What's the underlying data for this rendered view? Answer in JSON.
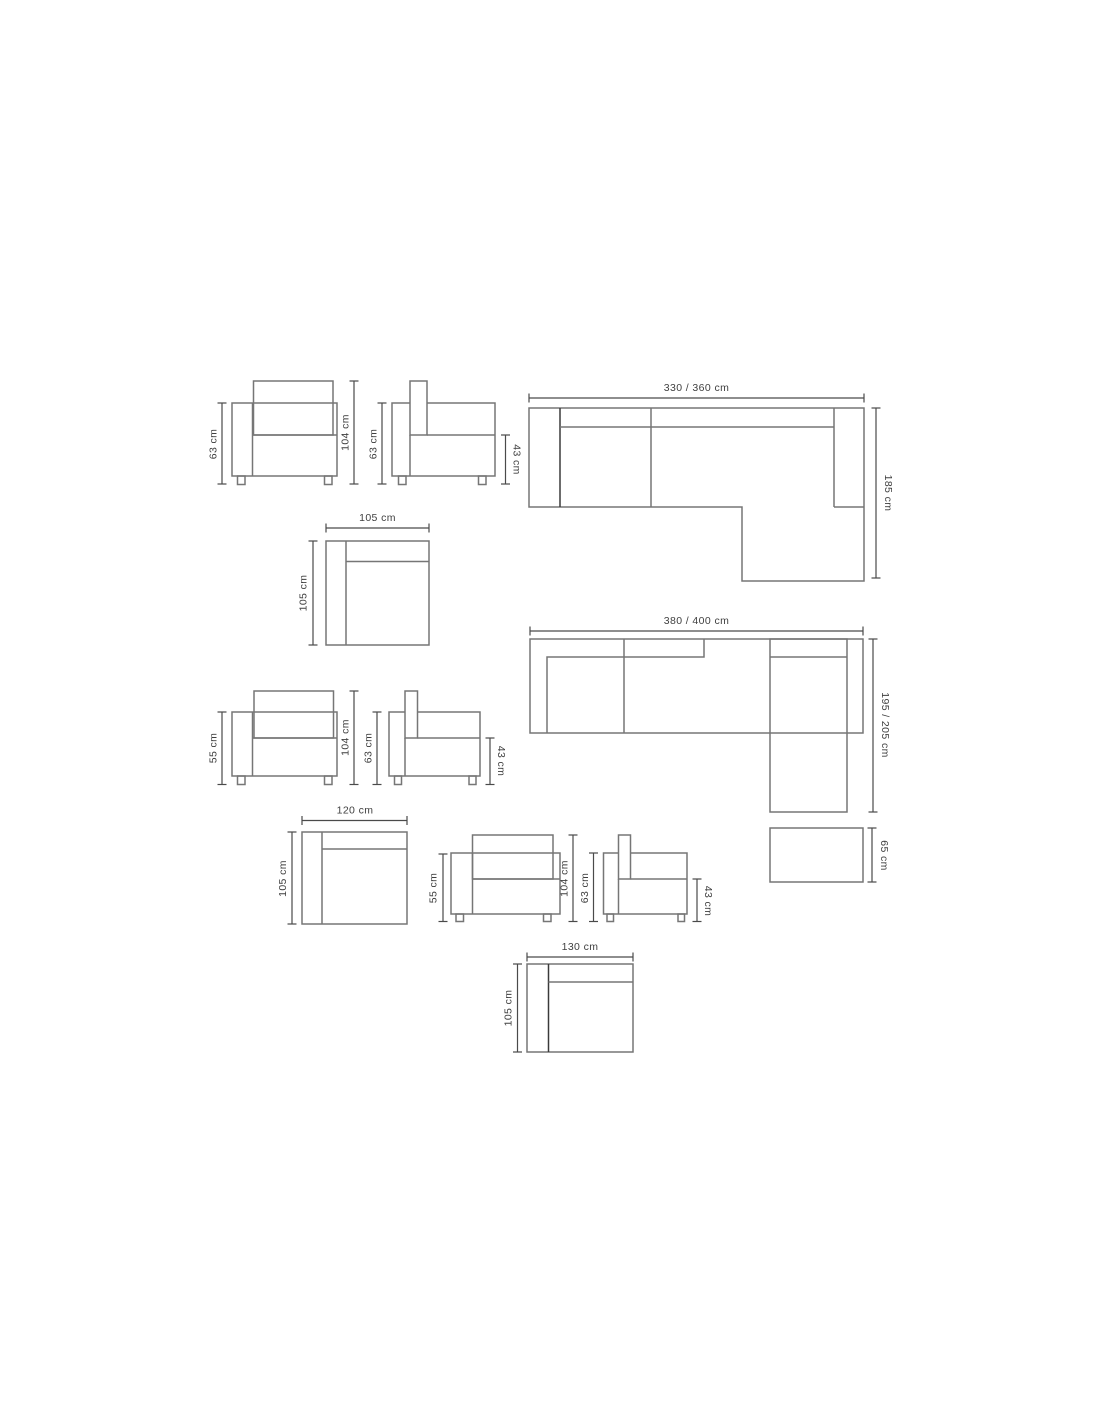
{
  "colors": {
    "background": "#ffffff",
    "furniture_line": "#767676",
    "dimension_line": "#4a4a4a",
    "text": "#3f3f3f"
  },
  "labels": {
    "armchair1_front": {
      "height": "63 cm",
      "total_height": "104 cm"
    },
    "armchair1_side": {
      "height": "63 cm",
      "seat_height": "43 cm"
    },
    "sectional1": {
      "width": "330 / 360 cm",
      "depth": "185 cm"
    },
    "module105": {
      "width": "105 cm",
      "depth": "105 cm"
    },
    "armchair2_front": {
      "height": "55 cm",
      "total_height": "104 cm"
    },
    "armchair2_side": {
      "height": "63 cm",
      "seat_height": "43 cm"
    },
    "sectional2": {
      "width": "380 / 400 cm",
      "depth": "195 / 205 cm"
    },
    "module120": {
      "width": "120 cm",
      "depth": "105 cm"
    },
    "armchair3_front": {
      "height": "55 cm",
      "total_height": "104 cm"
    },
    "armchair3_side": {
      "height": "63 cm",
      "seat_height": "43 cm"
    },
    "ottoman": {
      "depth": "65 cm"
    },
    "module130": {
      "width": "130 cm",
      "depth": "105 cm"
    }
  }
}
